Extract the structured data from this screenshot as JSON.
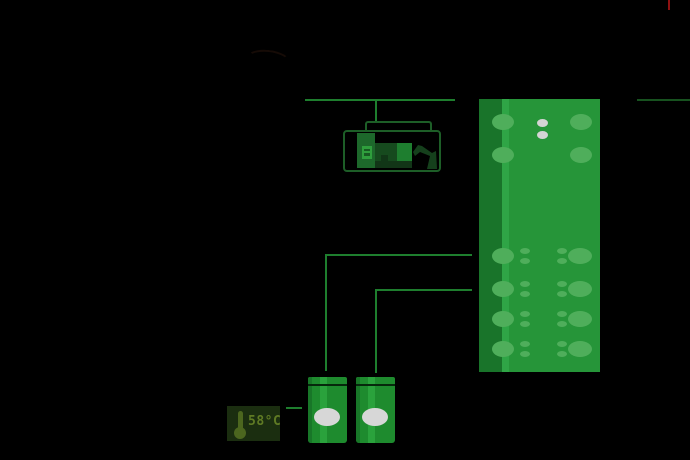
{
  "canvas": {
    "width": 690,
    "height": 460,
    "background": "#000000"
  },
  "colors": {
    "line_green": "#1e7e2e",
    "line_dim": "#17521f",
    "enclosure_outline": "#1d5e27",
    "panel_body": "#269539",
    "panel_edge": "#19742a",
    "panel_highlight": "#2fa546",
    "port": "#4fae5b",
    "dot": "#d4d4d4",
    "canister_body": "#1e8b2e",
    "canister_label": "#d7d7d7",
    "thermo_bg": "#1b2e10",
    "thermo_fg": "#4c661f",
    "thermo_text_color": "#5f7a24",
    "alert_red": "#8f1111"
  },
  "temperature_label": {
    "text": "58°C"
  },
  "panel_ports": [
    {
      "cx": 24,
      "cy": 23,
      "rx": 11,
      "ry": 8,
      "c": "port"
    },
    {
      "cx": 102,
      "cy": 23,
      "rx": 11,
      "ry": 8,
      "c": "port"
    },
    {
      "cx": 63,
      "cy": 24,
      "rx": 5.5,
      "ry": 4,
      "c": "dot"
    },
    {
      "cx": 63,
      "cy": 36,
      "rx": 5.5,
      "ry": 4,
      "c": "dot"
    },
    {
      "cx": 24,
      "cy": 56,
      "rx": 11,
      "ry": 8,
      "c": "port"
    },
    {
      "cx": 102,
      "cy": 56,
      "rx": 11,
      "ry": 8,
      "c": "port"
    },
    {
      "cx": 24,
      "cy": 157,
      "rx": 11,
      "ry": 8,
      "c": "port"
    },
    {
      "cx": 46,
      "cy": 152,
      "rx": 5,
      "ry": 3,
      "c": "port"
    },
    {
      "cx": 46,
      "cy": 162,
      "rx": 5,
      "ry": 3,
      "c": "port"
    },
    {
      "cx": 83,
      "cy": 152,
      "rx": 5,
      "ry": 3,
      "c": "port"
    },
    {
      "cx": 83,
      "cy": 162,
      "rx": 5,
      "ry": 3,
      "c": "port"
    },
    {
      "cx": 101,
      "cy": 157,
      "rx": 12,
      "ry": 8,
      "c": "port"
    },
    {
      "cx": 24,
      "cy": 190,
      "rx": 11,
      "ry": 8,
      "c": "port"
    },
    {
      "cx": 46,
      "cy": 185,
      "rx": 5,
      "ry": 3,
      "c": "port"
    },
    {
      "cx": 46,
      "cy": 195,
      "rx": 5,
      "ry": 3,
      "c": "port"
    },
    {
      "cx": 83,
      "cy": 185,
      "rx": 5,
      "ry": 3,
      "c": "port"
    },
    {
      "cx": 83,
      "cy": 195,
      "rx": 5,
      "ry": 3,
      "c": "port"
    },
    {
      "cx": 101,
      "cy": 190,
      "rx": 12,
      "ry": 8,
      "c": "port"
    },
    {
      "cx": 24,
      "cy": 220,
      "rx": 11,
      "ry": 8,
      "c": "port"
    },
    {
      "cx": 46,
      "cy": 215,
      "rx": 5,
      "ry": 3,
      "c": "port"
    },
    {
      "cx": 46,
      "cy": 225,
      "rx": 5,
      "ry": 3,
      "c": "port"
    },
    {
      "cx": 83,
      "cy": 215,
      "rx": 5,
      "ry": 3,
      "c": "port"
    },
    {
      "cx": 83,
      "cy": 225,
      "rx": 5,
      "ry": 3,
      "c": "port"
    },
    {
      "cx": 101,
      "cy": 220,
      "rx": 12,
      "ry": 8,
      "c": "port"
    },
    {
      "cx": 24,
      "cy": 250,
      "rx": 11,
      "ry": 8,
      "c": "port"
    },
    {
      "cx": 46,
      "cy": 245,
      "rx": 5,
      "ry": 3,
      "c": "port"
    },
    {
      "cx": 46,
      "cy": 255,
      "rx": 5,
      "ry": 3,
      "c": "port"
    },
    {
      "cx": 83,
      "cy": 245,
      "rx": 5,
      "ry": 3,
      "c": "port"
    },
    {
      "cx": 83,
      "cy": 255,
      "rx": 5,
      "ry": 3,
      "c": "port"
    },
    {
      "cx": 101,
      "cy": 250,
      "rx": 12,
      "ry": 8,
      "c": "port"
    }
  ]
}
